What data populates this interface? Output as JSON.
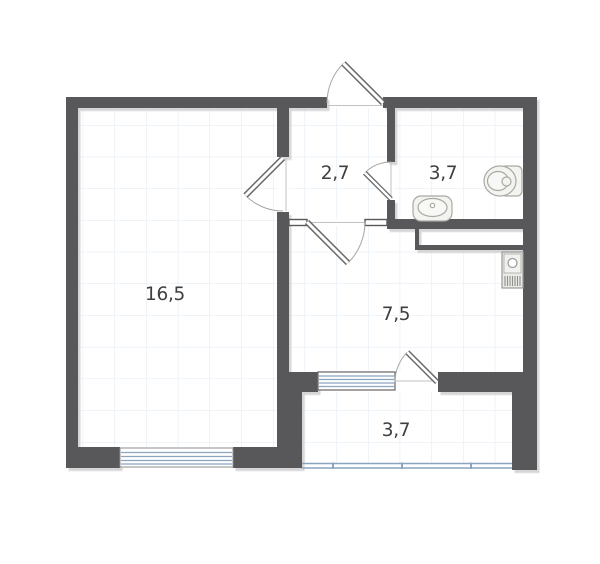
{
  "plan": {
    "title": "apartment-floor-plan",
    "rooms": [
      {
        "name": "living-room",
        "area_label": "16,5"
      },
      {
        "name": "hallway",
        "area_label": "2,7"
      },
      {
        "name": "bathroom",
        "area_label": "3,7"
      },
      {
        "name": "kitchen",
        "area_label": "7,5"
      },
      {
        "name": "balcony",
        "area_label": "3,7"
      }
    ],
    "fixtures": [
      {
        "type": "toilet",
        "room": "bathroom"
      },
      {
        "type": "sink",
        "room": "bathroom"
      },
      {
        "type": "stove",
        "room": "kitchen"
      }
    ],
    "colors": {
      "wall": "#58585a",
      "grid_line": "#dfe9f3",
      "window_glass": "#8ba5c0",
      "door_arc": "#a6a6a6",
      "door_leaf": "#6a6a6a",
      "fixture_stroke": "#a9a9a3",
      "label_text": "#3f3f3f"
    }
  }
}
